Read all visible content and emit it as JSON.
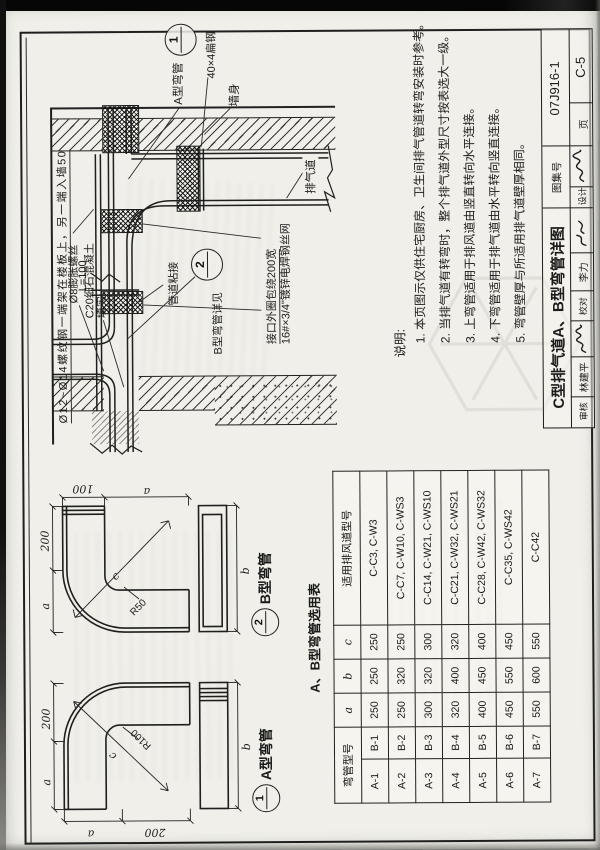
{
  "page": {
    "atlas_label": "图集号",
    "atlas_no": "07J916-1",
    "page_label": "页",
    "page_no": "C-5",
    "title": "C型排气道A、B型弯管详图",
    "credits": {
      "reviewer_label": "审核",
      "reviewer_name": "林建平",
      "checker_label": "校对",
      "checker_name": "李力",
      "designer_label": "设计"
    }
  },
  "detail": {
    "labels": {
      "rebar": "Ø12~Ø14螺纹钢一端架在楼板上，另一端入墙50",
      "anchor1": "Ø8膨胀螺丝",
      "anchor2": "L=100",
      "concrete1": "C20细石混凝土",
      "concrete2": "填实",
      "flat_steel": "40×4扁钢",
      "wall": "墙身",
      "a_elbow": "A型弯管",
      "joint": "管道粘接",
      "b_elbow_ref": "B型弯管详见",
      "mesh1": "接口外圈包绕200宽",
      "mesh2": "16#×3/4\"镀锌电焊钢丝网",
      "duct": "排气道",
      "mark1": "1",
      "mark2": "2"
    }
  },
  "figures": {
    "a": {
      "mark": "1",
      "name": "A型弯管",
      "radius": "R100",
      "diag": "c",
      "dim_top": [
        "a",
        "200"
      ],
      "dim_left": [
        "a",
        "200"
      ],
      "dim_b": "b"
    },
    "b": {
      "mark": "2",
      "name": "B型弯管",
      "radius": "R50",
      "diag": "c",
      "dim_top": [
        "a",
        "200"
      ],
      "dim_right": [
        "100",
        "a"
      ],
      "dim_b": "b"
    }
  },
  "table": {
    "caption": "A、B型弯管选用表",
    "col_model": "弯管型号",
    "col_a": "a",
    "col_b": "b",
    "col_c": "c",
    "col_use": "适用排风道型号",
    "rows": [
      {
        "ma": "A-1",
        "mb": "B-1",
        "a": "250",
        "b": "250",
        "c": "250",
        "use": "C-C3, C-W3"
      },
      {
        "ma": "A-2",
        "mb": "B-2",
        "a": "250",
        "b": "320",
        "c": "250",
        "use": "C-C7, C-W10, C-WS3"
      },
      {
        "ma": "A-3",
        "mb": "B-3",
        "a": "300",
        "b": "320",
        "c": "300",
        "use": "C-C14, C-W21, C-WS10"
      },
      {
        "ma": "A-4",
        "mb": "B-4",
        "a": "320",
        "b": "400",
        "c": "320",
        "use": "C-C21, C-W32, C-WS21"
      },
      {
        "ma": "A-5",
        "mb": "B-5",
        "a": "400",
        "b": "450",
        "c": "400",
        "use": "C-C28, C-W42, C-WS32"
      },
      {
        "ma": "A-6",
        "mb": "B-6",
        "a": "450",
        "b": "550",
        "c": "450",
        "use": "C-C35, C-WS42"
      },
      {
        "ma": "A-7",
        "mb": "B-7",
        "a": "550",
        "b": "600",
        "c": "550",
        "use": "C-C42"
      }
    ]
  },
  "notes": {
    "label": "说明:",
    "lines": [
      "1. 本页图示仅供住宅厨房、卫生间排气管道转弯安装时参考。",
      "2. 当排气道有转弯时，整个排气道外型尺寸按表选大一级。",
      "3. 上弯管适用于排风道由竖直转向水平连接。",
      "4. 下弯管适用于排气道由水平转向竖直连接。",
      "5. 弯管壁厚与所适用排气道壁厚相同。"
    ]
  }
}
